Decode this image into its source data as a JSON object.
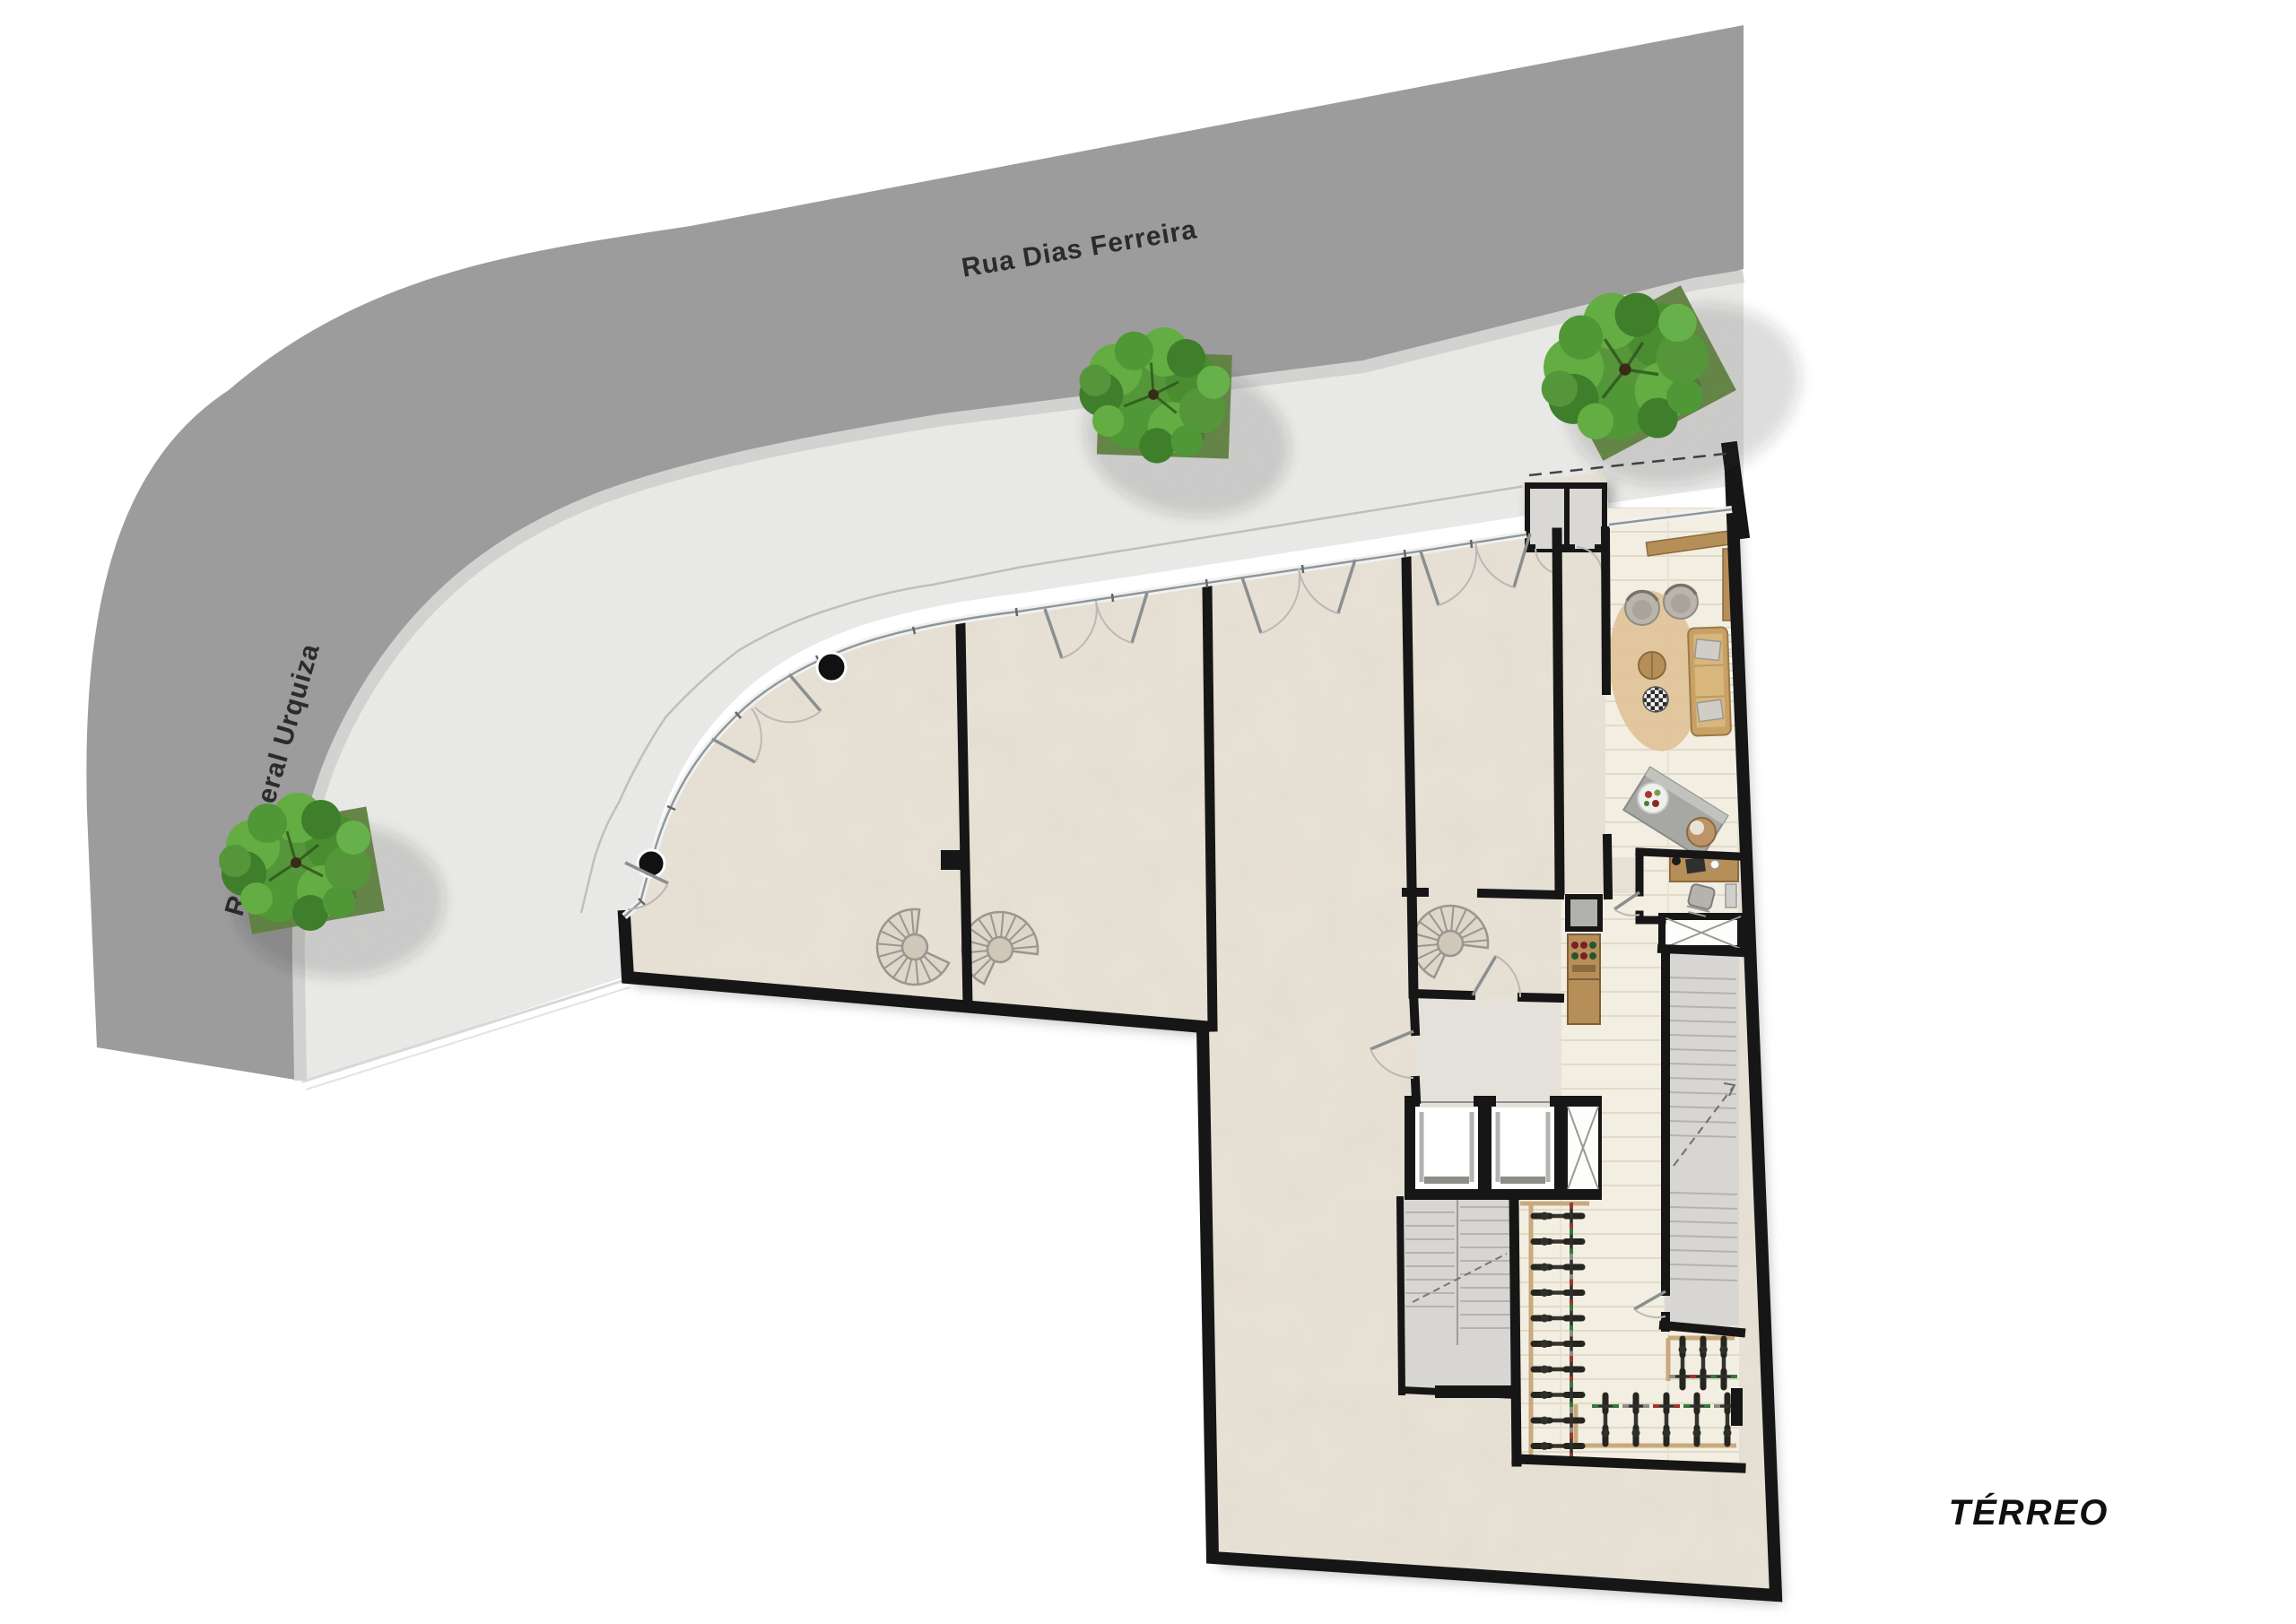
{
  "page": {
    "floor_label": "TÉRREO",
    "drawing_type": "ground-floor architectural plan"
  },
  "streets": {
    "horizontal": "Rua Dias Ferreira",
    "vertical": "Rua General Urquiza"
  },
  "colors": {
    "street": "#9c9c9c",
    "curb": "#d2d2d0",
    "sidewalk": "#ededec",
    "floor": "#e8e1d6",
    "floor_hall": "#f3eee2",
    "floor_gray": "#d7d6d2",
    "vestibule": "#e3e1da",
    "wall": "#161616",
    "wood": "#b68e58",
    "rack": "#c9a97c",
    "rug": "#dfc39a",
    "tree_canopy": "#55963a",
    "grass": "#5f8040",
    "bike_red": "#a3342c",
    "bike_green": "#2f7d3a",
    "label": "#2b2b2b"
  },
  "icons": {
    "tree_count": 3,
    "spiral_stair_count": 3,
    "elevator_count": 2,
    "facade_column_count": 2,
    "storefront_door_sets": 4,
    "bicycles": {
      "wall_column": 10,
      "bottom_row": 5,
      "nook": 3
    }
  }
}
